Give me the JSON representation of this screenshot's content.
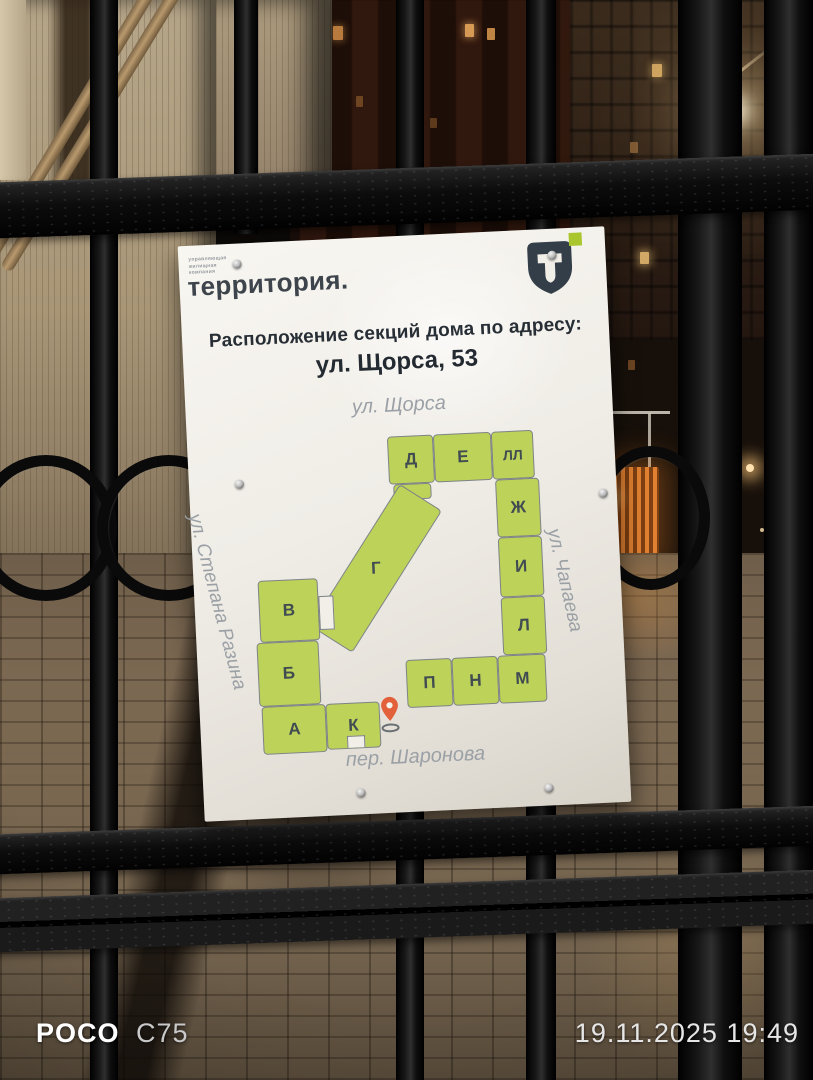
{
  "watermark": {
    "brand": "POCO",
    "model": "C75",
    "datetime": "19.11.2025 19:49"
  },
  "sign": {
    "company_lines": [
      "управляющая",
      "жилищная",
      "компания"
    ],
    "brand": "территория.",
    "logo_letter": "T",
    "title": "Расположение секций дома по адресу:",
    "address": "ул. Щорса, 53",
    "streets": {
      "top": "ул. Щорса",
      "left": "ул. Степана Разина",
      "right": "ул. Чапаева",
      "bottom": "пер. Шаронова"
    },
    "sections": [
      "Д",
      "Е",
      "ЛЛ",
      "Ж",
      "И",
      "Л",
      "М",
      "Н",
      "П",
      "Г",
      "В",
      "Б",
      "А",
      "К"
    ],
    "colors": {
      "section_fill": "#bcd258",
      "section_border": "#7e8387",
      "accent_green": "#a9c62f",
      "logo_dark": "#333e48",
      "pin_orange": "#e2603a"
    }
  }
}
